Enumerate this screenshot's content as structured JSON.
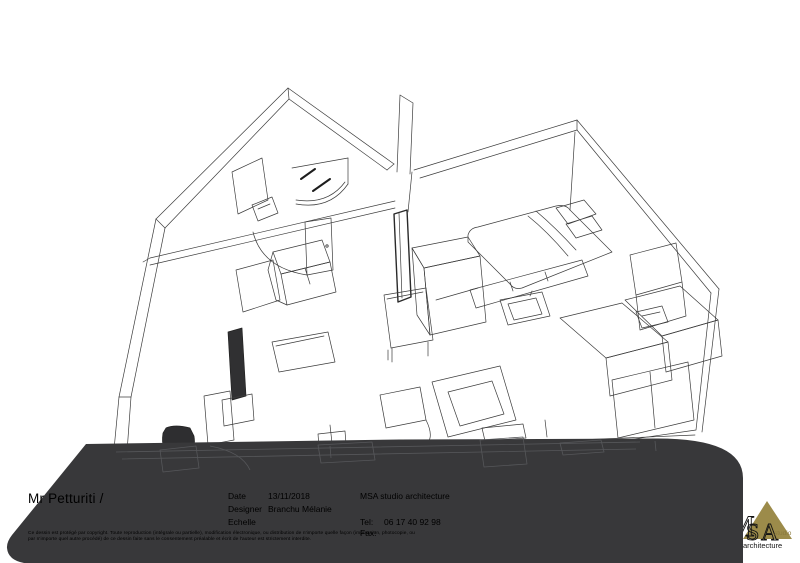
{
  "title_block": {
    "client": "Mr Petturiti /",
    "date_label": "Date",
    "date_value": "13/11/2018",
    "designer_label": "Designer",
    "designer_value": "Branchu Mélanie",
    "scale_label": "Echelle",
    "scale_value": "",
    "company": "MSA studio architecture",
    "tel_label": "Tel:",
    "tel_value": "06 17 40 92 98",
    "fax_label": "Fax:",
    "fax_value": ""
  },
  "copyright": {
    "line1": "Ce dessin est protégé par copyright. Toute reproduction (intégrale ou partielle),  modification électronique, ou distribution de n'importe quelle façon (impression, photocopie, ou",
    "line2": "par n'importe quel autre procédé) de ce dessin faite sans le consentement préalable et écrit de l'auteur est strictement interdite."
  },
  "logo": {
    "letter_m": "M",
    "letter_s": "S",
    "letter_a": "A",
    "studio": "studio",
    "architecture": "architecture"
  },
  "colors": {
    "panel": "#38383a",
    "panel_inner_line": "#56575a",
    "drawing_line": "#3c3c3c",
    "logo_gold": "#9c8b4a",
    "text": "#000000"
  }
}
